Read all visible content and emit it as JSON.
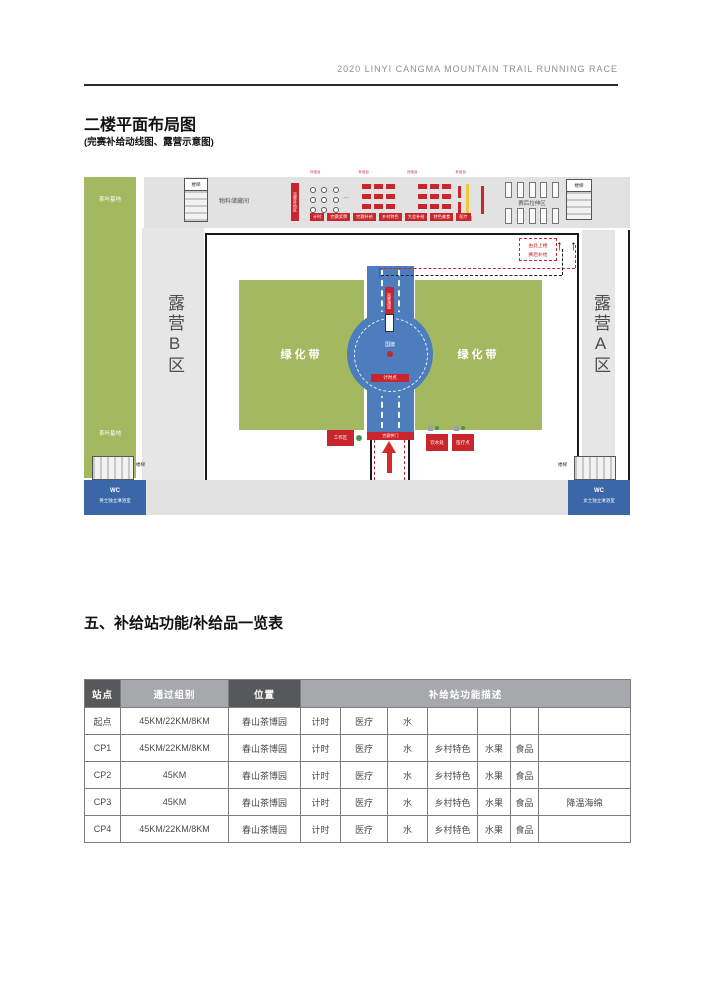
{
  "header": {
    "race_title": "2020 LINYI CANGMA MOUNTAIN TRAIL RUNNING RACE"
  },
  "plan": {
    "title": "二楼平面布局图",
    "subtitle": "(完赛补给动线图、露营示意图)",
    "labels": {
      "tea_base": "茶叶基地",
      "stairs": "楼梯",
      "storage_room": "物料储藏间",
      "finish_supply_banner": "完赛补给区",
      "top_marks": [
        "补给台",
        "补给台",
        "补给台",
        "补给台"
      ],
      "supply_items": [
        "计时",
        "完赛奖牌",
        "完赛补给",
        "乡村特色",
        "大会补给",
        "特色美食",
        "医疗"
      ],
      "stretch_area": "赛后拉伸区",
      "camp_b": "露营B区",
      "camp_a": "露营A区",
      "green_belt": "绿化带",
      "national_flag": "国旗",
      "road_banner": "完赛通道",
      "timing_point": "计时点",
      "finish_arch": "完赛拱门",
      "work_area": "工作区",
      "water_station": "饮水处",
      "medical_station": "医疗点",
      "upstairs_line1": "由此上楼",
      "upstairs_line2": "赛后补给",
      "arrow_up": "↑",
      "wc": "WC",
      "wc_men": "男士独立淋浴室",
      "wc_women": "女士独立淋浴室"
    },
    "colors": {
      "green": "#a4b860",
      "road_blue": "#4d7dbd",
      "accent_red": "#c9252c",
      "wc_blue": "#3b67a9",
      "corridor_gray": "#e2e2e2"
    }
  },
  "table": {
    "section_title": "五、补给站功能/补给品一览表",
    "headers": {
      "station": "站点",
      "groups": "通过组别",
      "location": "位置",
      "functions": "补给站功能描述"
    },
    "header_colors": {
      "dark": "#57585a",
      "gray": "#a6a8ab"
    },
    "rows": [
      {
        "station": "起点",
        "groups": "45KM/22KM/8KM",
        "location": "春山茶博园",
        "functions": [
          "计时",
          "医疗",
          "水",
          "",
          "",
          "",
          ""
        ]
      },
      {
        "station": "CP1",
        "groups": "45KM/22KM/8KM",
        "location": "春山茶博园",
        "functions": [
          "计时",
          "医疗",
          "水",
          "乡村特色",
          "水果",
          "食品",
          ""
        ]
      },
      {
        "station": "CP2",
        "groups": "45KM",
        "location": "春山茶博园",
        "functions": [
          "计时",
          "医疗",
          "水",
          "乡村特色",
          "水果",
          "食品",
          ""
        ]
      },
      {
        "station": "CP3",
        "groups": "45KM",
        "location": "春山茶博园",
        "functions": [
          "计时",
          "医疗",
          "水",
          "乡村特色",
          "水果",
          "食品",
          "降温海绵"
        ]
      },
      {
        "station": "CP4",
        "groups": "45KM/22KM/8KM",
        "location": "春山茶博园",
        "functions": [
          "计时",
          "医疗",
          "水",
          "乡村特色",
          "水果",
          "食品",
          ""
        ]
      }
    ]
  }
}
